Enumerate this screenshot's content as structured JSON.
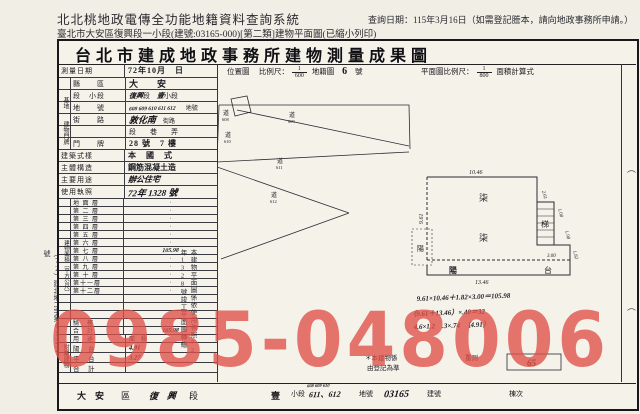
{
  "header": {
    "system_title": "北北桃地政電傳全功能地籍資料查詢系統",
    "query_date": "查詢日期：115年3月16日（如需登記謄本，請向地政事務所申請。）",
    "subtitle": "臺北市大安區復興段一小段(建號:03165-000)[第二類]建物平面圖(已縮小列印)"
  },
  "watermark": {
    "text": "0985-048006",
    "color": "#e05048"
  },
  "form": {
    "title": "台北市建成地政事務所建物測量成果圖",
    "doc_no": "（72）建北地二字第6122號",
    "survey_date_label": "測量日期",
    "survey_date_value": "72年10月　日",
    "loc_map_label": "位置圖",
    "scale_label": "比例尺：",
    "loc_num": "1",
    "loc_den": "600",
    "cad_label": "地籍圖",
    "cad_no": "6",
    "cad_unit": "號",
    "plan_scale_label": "平面圖比例尺：",
    "plan_num": "1",
    "plan_den": "800",
    "area_calc_label": "面積計算式",
    "county_label": "縣　　區",
    "county_value": "大　安",
    "sec_label": "段　小段",
    "sec_v1": "復興",
    "sec_v2": "段",
    "sec_v3": "壹",
    "sec_v4": "小段",
    "land_label": "地　　號",
    "land_value": "608 609 610 611 612",
    "land_suffix": "地號",
    "street_label": "街　　路",
    "street_value": "敦化南",
    "street_suffix": "街路",
    "lane_row": "段　　巷　　弄",
    "door_label": "門　　牌",
    "door_value": "28 號　7 樓",
    "style_label": "建築式樣",
    "style_value": "本　國　式",
    "struct_label": "主體構造",
    "struct_value": "鋼筋混凝土造",
    "use_label": "主要用途",
    "use_value": "辦公住宅",
    "lic_label": "使用執照",
    "lic_value": "72年 1328 號",
    "grp_site": "基地",
    "grp_door": "建物門牌",
    "grp_area": "建物面積（平方公尺）",
    "grp_annex": "附屬建物",
    "annex_use_header": "用　途",
    "annex_area_header": "面　積",
    "transfer_note": "本建物平面圖係依使用執照72年1328號竣工平面圖轉繪",
    "sig_paren1": "（",
    "sig_paren2": "（"
  },
  "floors": {
    "rows": [
      {
        "label": "地 面 層",
        "value": "·"
      },
      {
        "label": "第 二 層",
        "value": "·"
      },
      {
        "label": "第 三 層",
        "value": "·"
      },
      {
        "label": "第 四 層",
        "value": "·"
      },
      {
        "label": "第 五 層",
        "value": "·"
      },
      {
        "label": "第 六 層",
        "value": "·"
      },
      {
        "label": "第 七 層",
        "value": "105.98",
        "cls": "hw"
      },
      {
        "label": "第 八 層",
        "value": "·"
      },
      {
        "label": "第 九 層",
        "value": "·"
      },
      {
        "label": "第 十 層",
        "value": "·"
      },
      {
        "label": "第十一層",
        "value": "·"
      },
      {
        "label": "第十二層",
        "value": "·"
      },
      {
        "label": "",
        "value": ""
      },
      {
        "label": "",
        "value": ""
      },
      {
        "label": "",
        "value": ""
      },
      {
        "label": "騎　樓",
        "value": "·"
      },
      {
        "label": "合　計",
        "value": "105.98",
        "cls": "hw"
      }
    ]
  },
  "annex": {
    "rows": [
      {
        "label": "陽　台",
        "value": "4.91",
        "cls": "hw"
      },
      {
        "label": "平　台",
        "value": "3.27",
        "cls": "hw"
      },
      {
        "label": "合　計",
        "value": ""
      }
    ]
  },
  "locmap": {
    "labels": [
      {
        "t": "道",
        "n": "608"
      },
      {
        "t": "道",
        "n": "609"
      },
      {
        "t": "道",
        "n": "610"
      },
      {
        "t": "道",
        "n": "611"
      },
      {
        "t": "道",
        "n": "612"
      }
    ]
  },
  "plan": {
    "dim_top": "10.46",
    "dim_bottom": "13.46",
    "dim_left": "9.61",
    "dim_r1": "2.61",
    "dim_r2": "1.08",
    "dim_r3": "1.98",
    "dim_r4": "3.00",
    "dim_r5": "1.82",
    "stair_label": "梯",
    "floor_mark_1": "柒",
    "floor_mark_2": "柒",
    "balcony_1": "陽",
    "balcony_2": "台",
    "box_small": "陽",
    "calc0": "9.61×10.46＋1.82×3.00＝105.98",
    "calc1": "（9.61＋13.46）×.40＝32",
    "calc2": "4.6×1.2　.3×.74　（4.91）"
  },
  "notes": {
    "note1": "＊本建物係",
    "note1b": "重測",
    "note2": "由登記為準",
    "box_value": "65"
  },
  "strip": {
    "district_value": "大　安",
    "district_label": "區",
    "sec_value": "復　興",
    "sec_label": "段",
    "sub_value": "壹",
    "sub_label": "小段",
    "land_small": "608 609 610",
    "land_value": "611、612",
    "land_label": "地號",
    "bno_value": "03165",
    "bno_label": "建號",
    "unit_label": "棟次"
  }
}
